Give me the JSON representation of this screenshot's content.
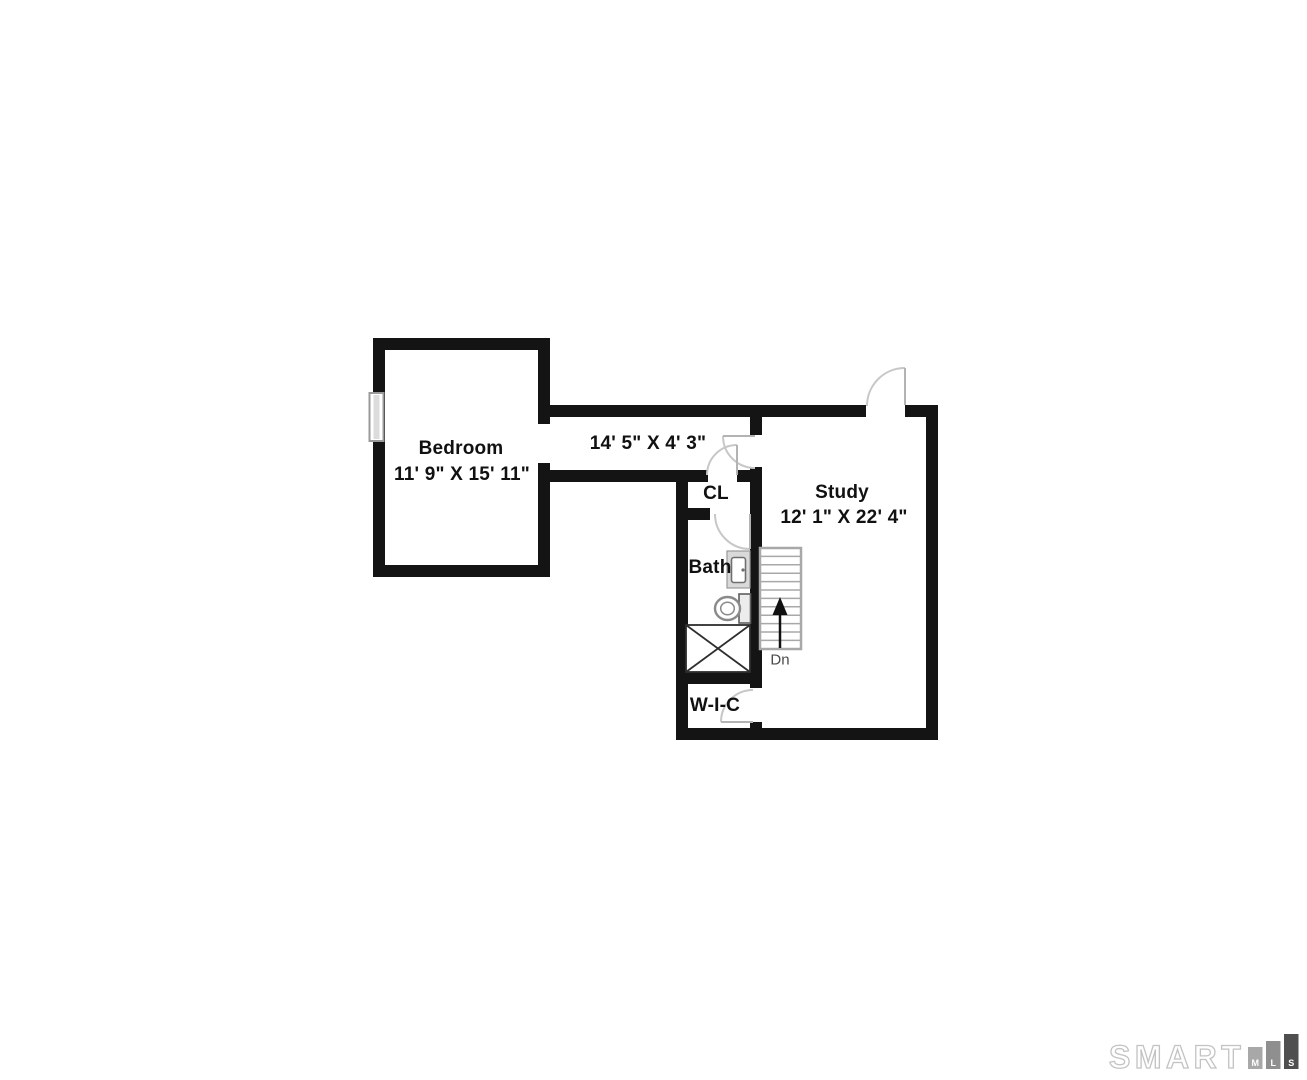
{
  "floorplan": {
    "title": "Second floor plan",
    "rooms": {
      "bedroom": {
        "name": "Bedroom",
        "dims": "11' 9\" X 15' 11\""
      },
      "hallway": {
        "dims": "14' 5\" X 4' 3\""
      },
      "closet": {
        "name": "CL"
      },
      "study": {
        "name": "Study",
        "dims": "12' 1\" X 22' 4\""
      },
      "bath": {
        "name": "Bath"
      },
      "wic": {
        "name": "W-I-C"
      }
    },
    "stairs": {
      "direction_label": "Dn"
    },
    "colors": {
      "wall": "#141414",
      "door_arc": "#c7c7c7",
      "stair_line": "#a8a8a8",
      "fixture_fill": "#d9d9d9"
    }
  },
  "logo": {
    "brand": "SMART",
    "bars": [
      {
        "letter": "M",
        "color": "#a8a8a8"
      },
      {
        "letter": "L",
        "color": "#8f8f8f"
      },
      {
        "letter": "S",
        "color": "#4f4f4f"
      }
    ]
  }
}
